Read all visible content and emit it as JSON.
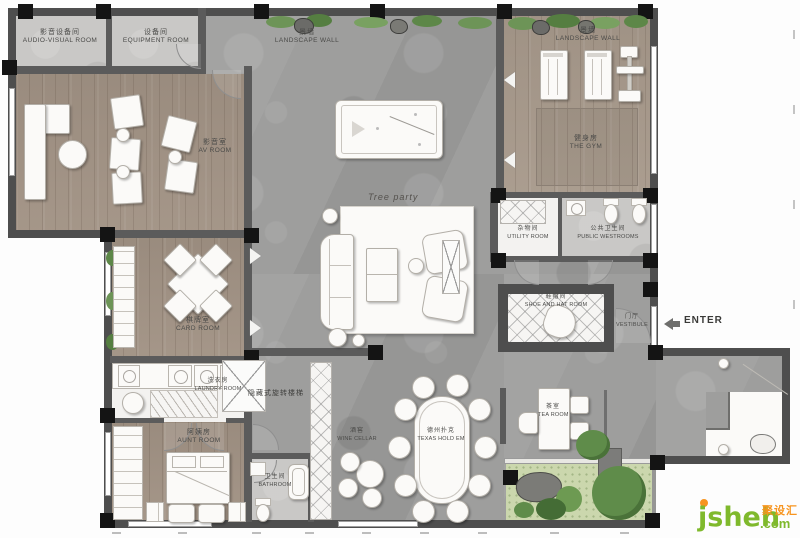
{
  "rooms": {
    "audio_visual": {
      "zh": "影音设备间",
      "en": "AUDIO-VISUAL ROOM"
    },
    "equipment": {
      "zh": "设备间",
      "en": "EQUIPMENT ROOM"
    },
    "landscape_wall_top": {
      "zh": "景墙",
      "en": "LANDSCAPE WALL"
    },
    "landscape_wall_gym": {
      "zh": "景墙",
      "en": "LANDSCAPE WALL"
    },
    "av_room": {
      "zh": "影音室",
      "en": "AV ROOM"
    },
    "gym": {
      "zh": "健身房",
      "en": "THE GYM"
    },
    "utility": {
      "zh": "杂物间",
      "en": "UTILITY ROOM"
    },
    "public_restrooms": {
      "zh": "公共卫生间",
      "en": "PUBLIC WESTROOMS"
    },
    "card_room": {
      "zh": "棋牌室",
      "en": "CARD ROOM"
    },
    "shoe_hat": {
      "zh": "鞋帽间",
      "en": "SHOE AND HAT ROOM"
    },
    "vestibule": {
      "zh": "门厅",
      "en": "VESTIBULE"
    },
    "laundry": {
      "zh": "洗衣房",
      "en": "LAUNDRY ROOM"
    },
    "aunt_room": {
      "zh": "阿姨房",
      "en": "AUNT ROOM"
    },
    "bathroom": {
      "zh": "卫生间",
      "en": "BATHROOM"
    },
    "wine_cellar": {
      "zh": "酒窖",
      "en": "WINE CELLAR"
    },
    "texas": {
      "zh": "德州扑克",
      "en": "TEXAS HOLD EM"
    },
    "tea_room": {
      "zh": "茶室",
      "en": "TEA ROOM"
    }
  },
  "labels": {
    "tree_party": "Tree party",
    "enter": "ENTER",
    "hidden_stair": "隐藏式旋转楼梯"
  },
  "watermark": {
    "site": "jsheh",
    "suffix": ".com",
    "brand": "聚设汇"
  },
  "colors": {
    "wall": "#4e4e4e",
    "column": "#141414",
    "wood_floor": "#a29385",
    "stone_floor": "#9e9e9d",
    "light_floor": "#c9c8c6",
    "garden_green": "#cbd7ad",
    "tree_green": "#5f8c4a",
    "watermark_green": "#7fb92c",
    "watermark_orange": "#f7941e"
  }
}
